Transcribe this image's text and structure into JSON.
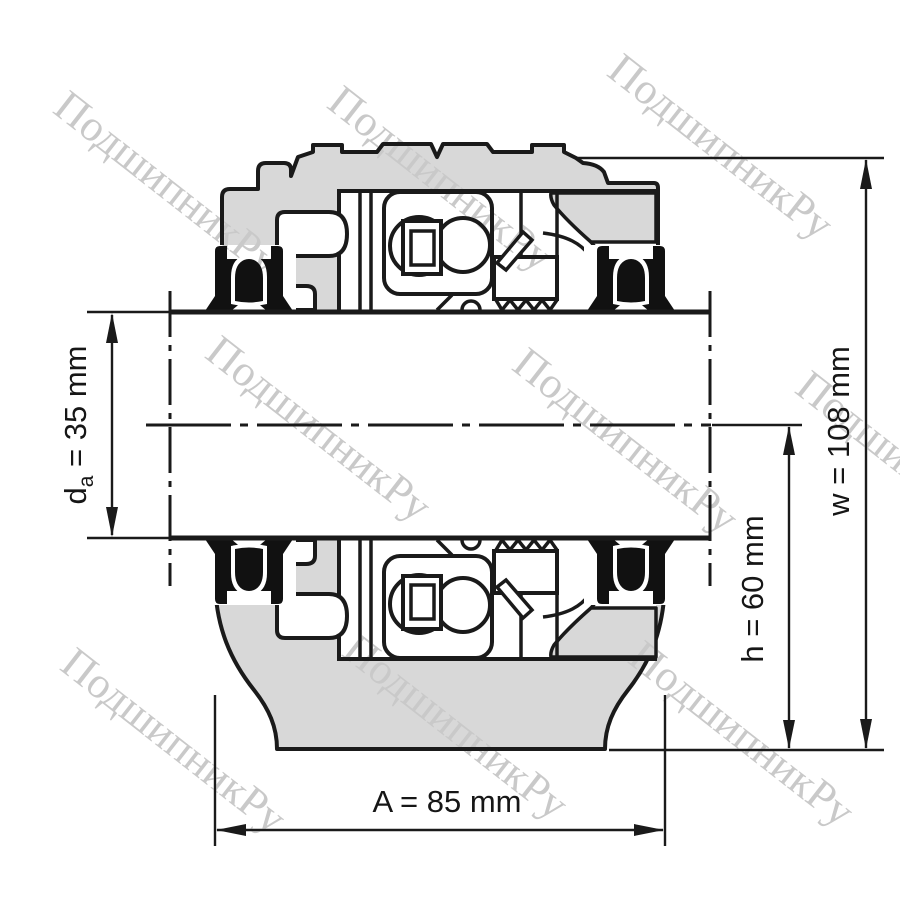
{
  "watermark": {
    "text": "ПодшипникРу"
  },
  "dimensions": {
    "shaft_diameter": {
      "symbol": "d",
      "subscript": "a",
      "rest": " = 35 mm",
      "value_mm": 35
    },
    "center_height": {
      "label": "h = 60 mm",
      "value_mm": 60
    },
    "total_height": {
      "label": "w = 108 mm",
      "value_mm": 108
    },
    "base_width": {
      "label": "A = 85 mm",
      "value_mm": 85
    }
  },
  "colors": {
    "line": "#1a1a1a",
    "housing_fill": "#d8d8d8",
    "seal_fill": "#111111",
    "watermark": "#c9c9c9",
    "background": "#ffffff"
  }
}
